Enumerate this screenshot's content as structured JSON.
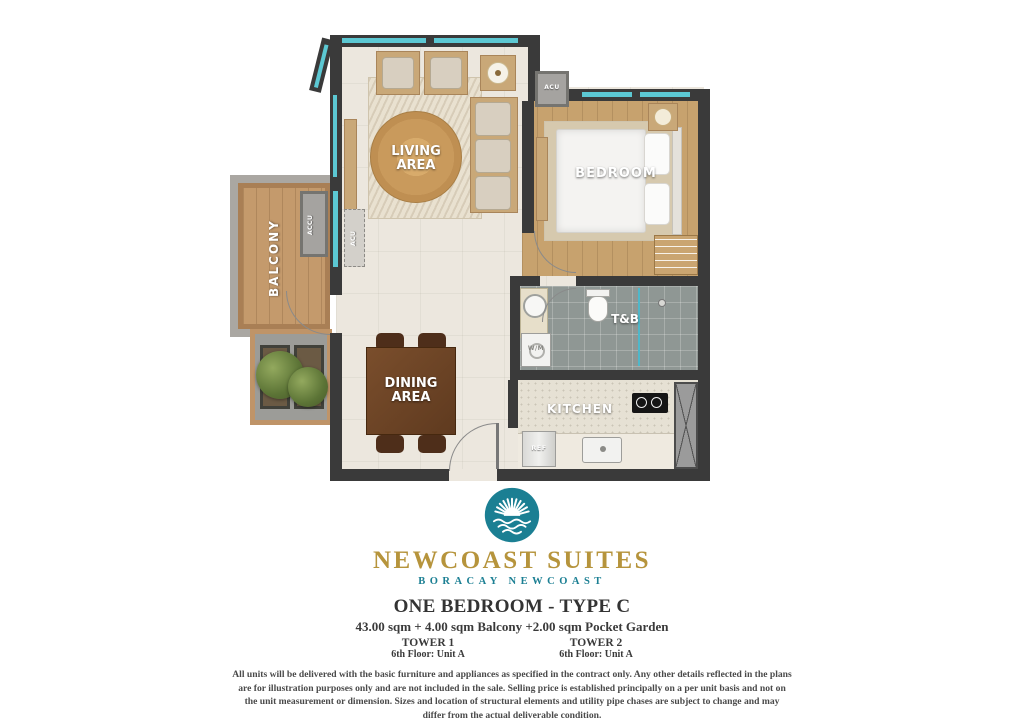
{
  "plan": {
    "living": "LIVING AREA",
    "bedroom": "BEDROOM",
    "balcony": "BALCONY",
    "dining": "DINING AREA",
    "toilet_bath": "T&B",
    "kitchen": "KITCHEN",
    "acu_top": "ACU",
    "accu": "ACCU",
    "acu_wall": "ACU",
    "wm": "W/M",
    "ref": "REF"
  },
  "branding": {
    "name": "NEWCOAST SUITES",
    "location": "BORACAY NEWCOAST"
  },
  "unit": {
    "title": "ONE BEDROOM - TYPE C",
    "area": "43.00 sqm + 4.00 sqm Balcony +2.00 sqm Pocket Garden",
    "towers": [
      {
        "name": "TOWER 1",
        "floor_unit": "6th Floor: Unit A"
      },
      {
        "name": "TOWER 2",
        "floor_unit": "6th Floor: Unit A"
      }
    ]
  },
  "disclaimer": {
    "text": "All units will be delivered with the basic furniture and appliances as specified in the contract only. Any other details reflected in the plans are for illustration purposes only and are not included in the sale. Selling price is established principally on a per unit basis and not on the unit measurement or dimension. Sizes and location of structural elements and utility pipe chases are subject to change and may differ from the actual deliverable condition."
  },
  "colors": {
    "brand_gold": "#b6943c",
    "brand_teal": "#1b7f93",
    "wall": "#3a3a3a",
    "window": "#5cc8d3"
  }
}
